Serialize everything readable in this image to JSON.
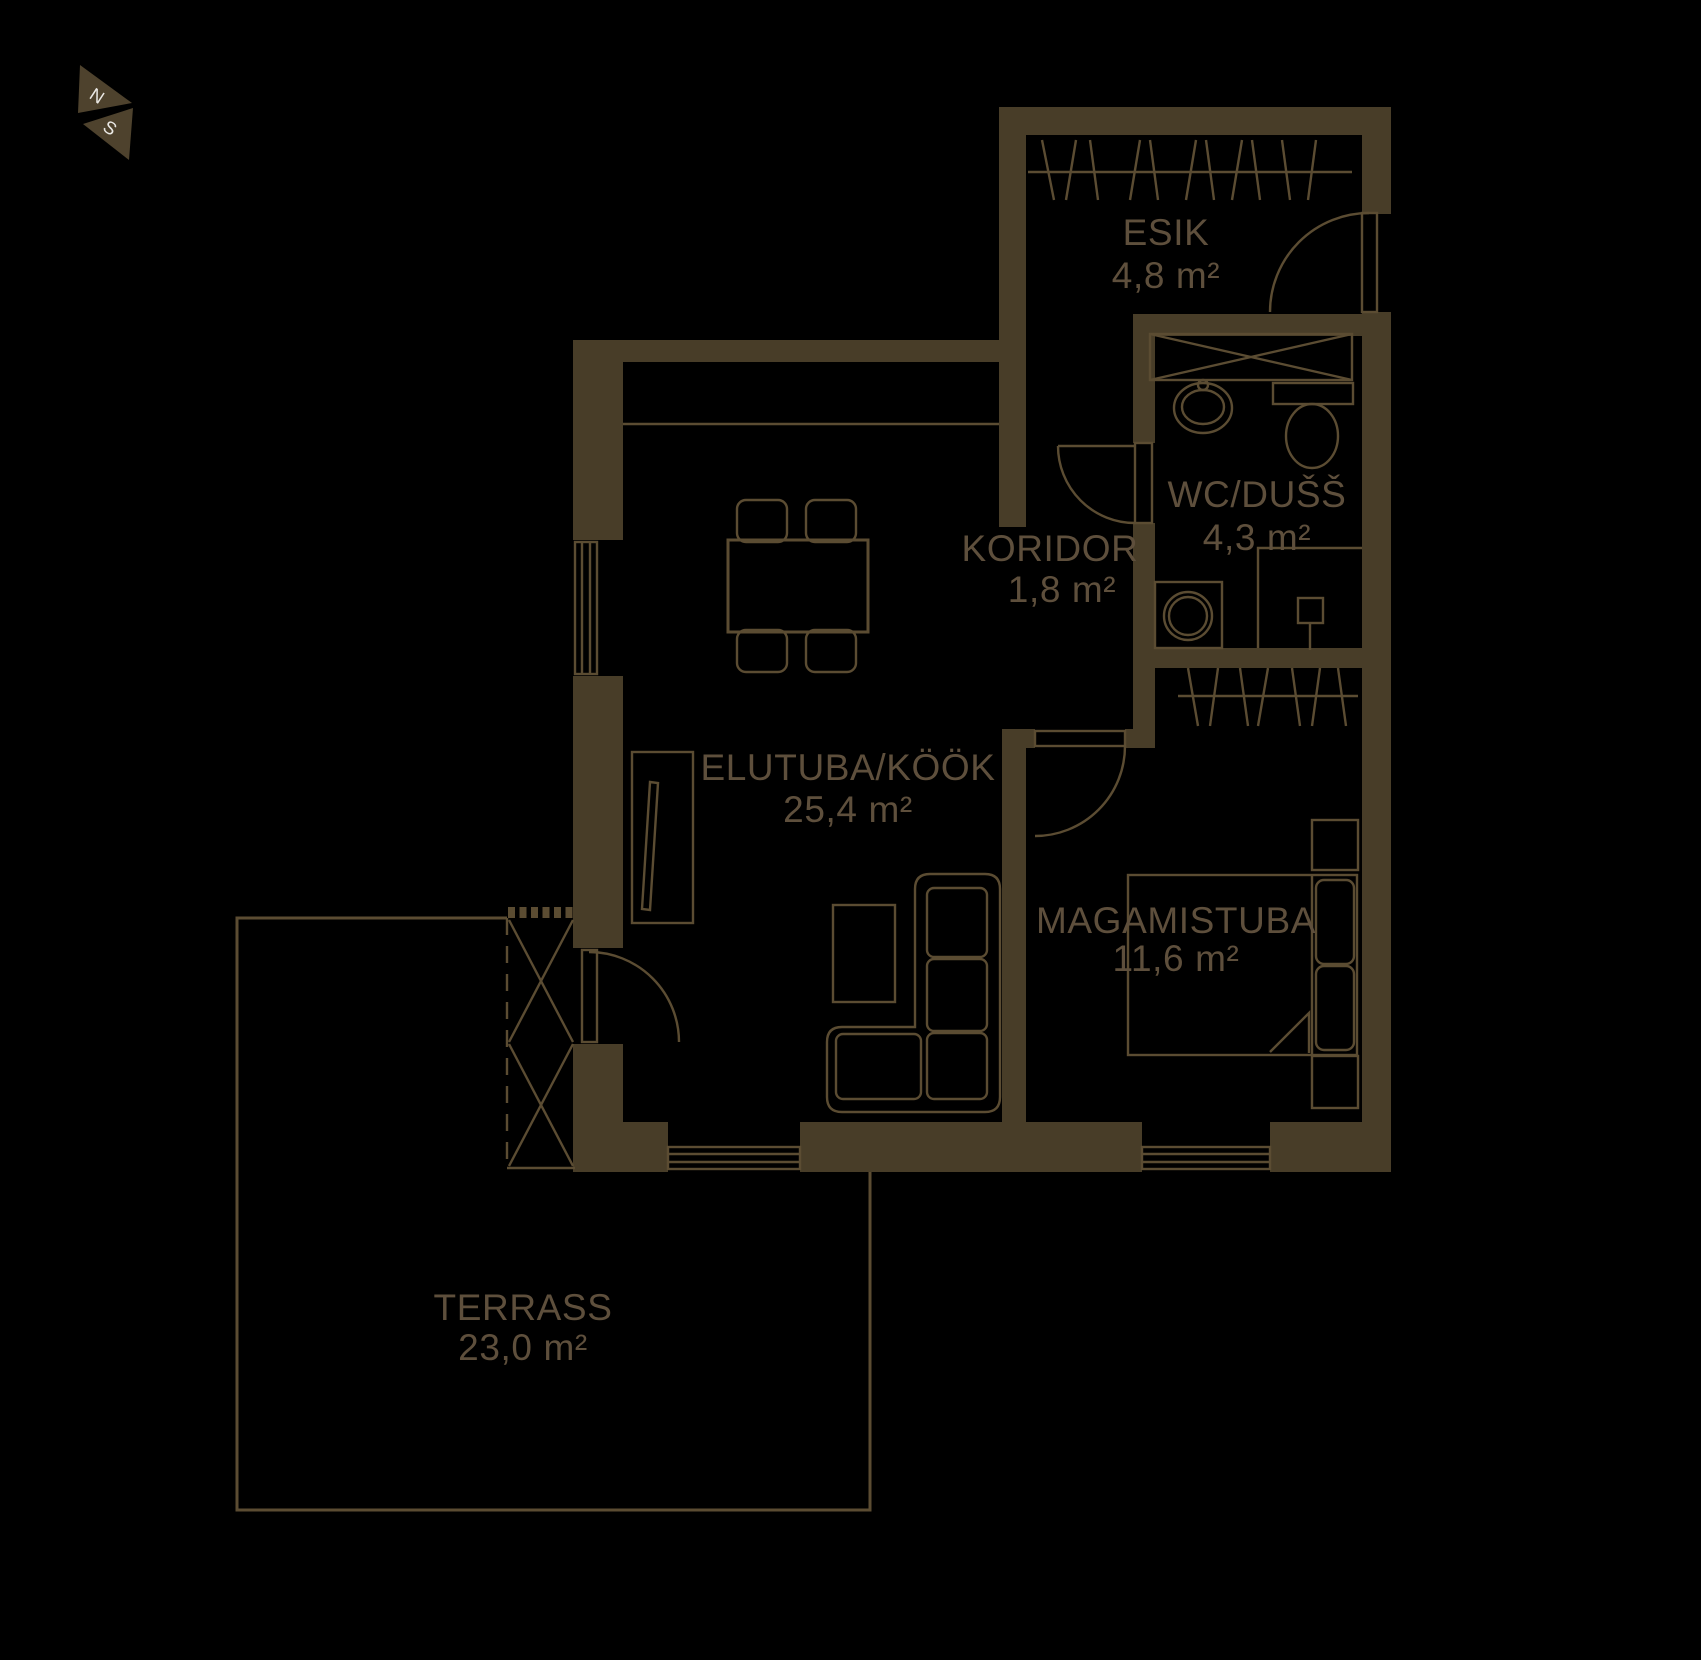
{
  "compass": {
    "north": "N",
    "south": "S"
  },
  "rooms": {
    "esik": {
      "name": "ESIK",
      "area": "4,8 m²"
    },
    "wc_duss": {
      "name": "WC/DUŠŠ",
      "area": "4,3 m²"
    },
    "koridor": {
      "name": "KORIDOR",
      "area": "1,8 m²"
    },
    "elutuba_kook": {
      "name": "ELUTUBA/KÖÖK",
      "area": "25,4 m²"
    },
    "magamistuba": {
      "name": "MAGAMISTUBA",
      "area": "11,6 m²"
    },
    "terrass": {
      "name": "TERRASS",
      "area": "23,0 m²"
    }
  },
  "colors": {
    "background": "#000000",
    "wall": "#483d28",
    "line": "#5b4c32",
    "text": "#5e4f3c",
    "compass_fill": "#4e422d",
    "compass_letter": "#eae8e4"
  }
}
